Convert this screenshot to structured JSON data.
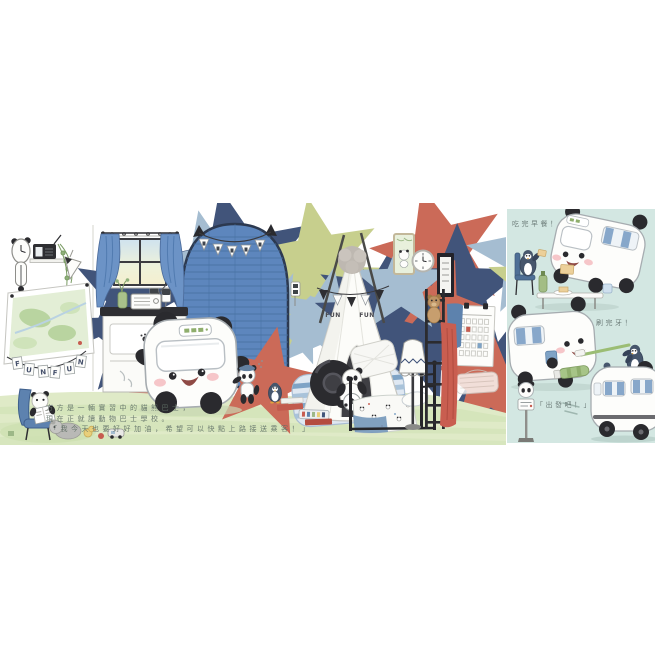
{
  "page": {
    "background_color": "#ffffff",
    "description": "picture-book spread: panda-bus bedroom scene with side panel"
  },
  "main_scene": {
    "caption": {
      "lines": [
        "方方是一輛實習中的貓熊巴士，",
        "現在正就讀動物巴士學校。",
        "「我今天也要好好加油，希望可以快點上路接送乘客！」"
      ]
    },
    "fun_banner_letters": [
      "F",
      "U",
      "N",
      "F",
      "U",
      "N"
    ],
    "teepee_text_words": [
      "FUN",
      "FUN"
    ]
  },
  "side_panel": {
    "vignettes": [
      {
        "caption": "吃完早餐！"
      },
      {
        "caption": "刷完牙！"
      },
      {
        "caption": "「出發吧！」"
      }
    ]
  },
  "colors": {
    "panel_background": "#d3e7e2",
    "door_blue": "#5d86bd",
    "door_stripe": "#47709f",
    "curtain_blue": "#6c93c6",
    "floor_green": "#dfeac7",
    "floor_stripe": "#d2e3b8",
    "rug_blue": "#7ea3c6",
    "star_navy": "#41547a",
    "star_red": "#cb6a58",
    "star_lightblue": "#a5bdd1",
    "star_yellowgreen": "#c7cf8d",
    "panda_black": "#2a2a2e",
    "cheek_pink": "#f5bcc0",
    "accent_red": "#c75c50",
    "caption_gray": "#5f6f66"
  }
}
